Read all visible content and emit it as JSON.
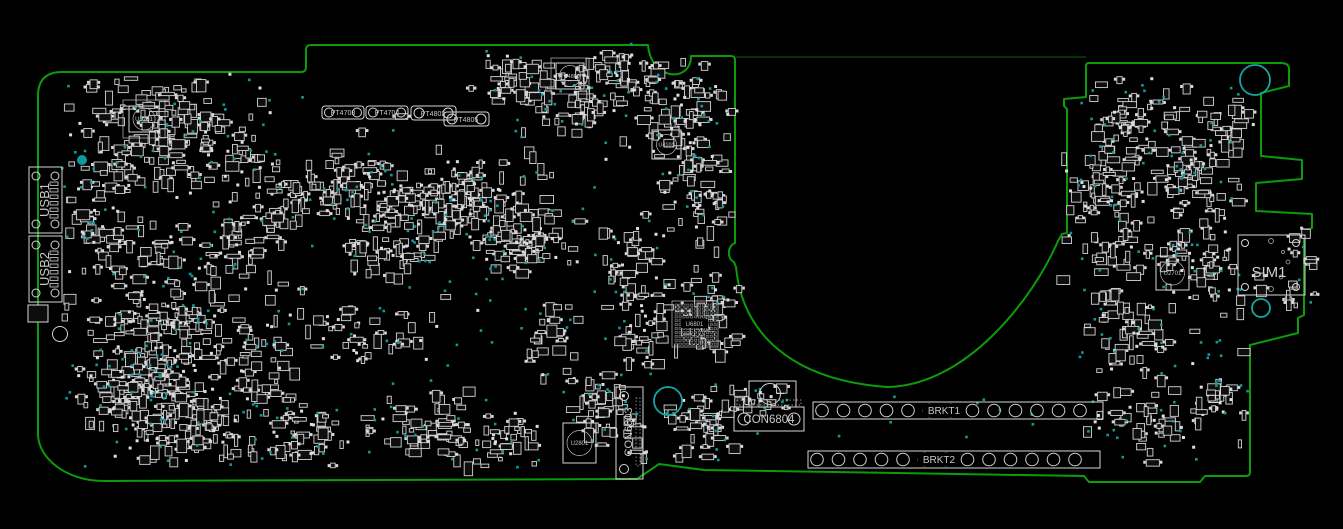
{
  "app": {
    "type": "pcb-boardview-screenshot",
    "background": "#000000"
  },
  "board": {
    "outline_color": "#0b9b0b",
    "silkscreen_color": "#d6d6d6",
    "testpoint_color": "#0f9a9a",
    "components": {
      "usb1": "USB1",
      "usb2": "USB2",
      "sim": "SIM1",
      "con6803": "CON6803",
      "con6804": "CON6804",
      "brkt1": "BRKT1",
      "brkt2": "BRKT2",
      "u5701": "U5701",
      "pu4800": "PU4800",
      "u4101": "U4101",
      "u6801": "U6801",
      "u2801": "U2801",
      "u2701": "U2701",
      "pt": [
        "PT4708",
        "PT4704",
        "PT4802",
        "PT4805"
      ]
    }
  }
}
